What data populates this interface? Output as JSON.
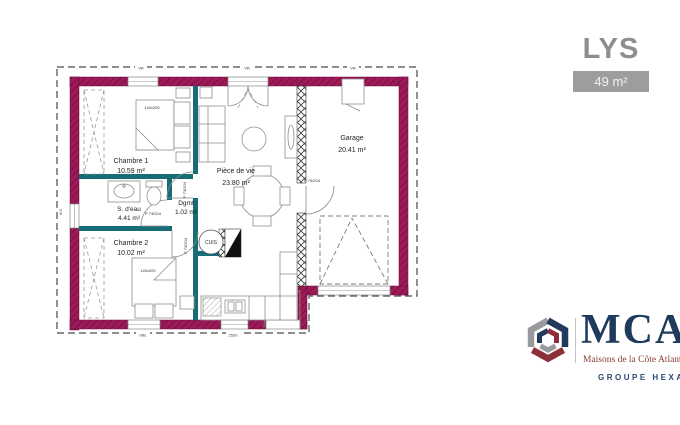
{
  "header": {
    "title": "LYS",
    "area_badge": "49 m²"
  },
  "plan": {
    "rooms": [
      {
        "name": "Chambre 1",
        "area": "10.59 m²"
      },
      {
        "name": "S. d'eau",
        "area": "4.41 m²"
      },
      {
        "name": "Dgmt",
        "area": "1.02 m²"
      },
      {
        "name": "Chambre 2",
        "area": "10.02 m²"
      },
      {
        "name": "Pièce de vie",
        "area": "23.80 m²"
      },
      {
        "name": "Garage",
        "area": "20.41 m²"
      }
    ],
    "labels": {
      "kitchen": "CUIS",
      "bed1_size": "140x200",
      "bed2_size": "140x200",
      "interior_door": "P 73/204",
      "garage_door": "P 75/204",
      "roller_shutter": "VR",
      "bay_window": "VBL",
      "bottom_dim": "2520",
      "left_dim": "8.0"
    }
  },
  "logo": {
    "brand": "MCA",
    "tagline": "Maisons de la Côte Atlantique",
    "group": "GROUPE HEXAOM"
  },
  "colors": {
    "wall": "#9d1a58",
    "partition": "#176d76",
    "title_gray": "#8e8e8e",
    "badge_bg": "#9d9d9d",
    "brand_navy": "#1e3a5c",
    "brand_red": "#8a3a33"
  }
}
